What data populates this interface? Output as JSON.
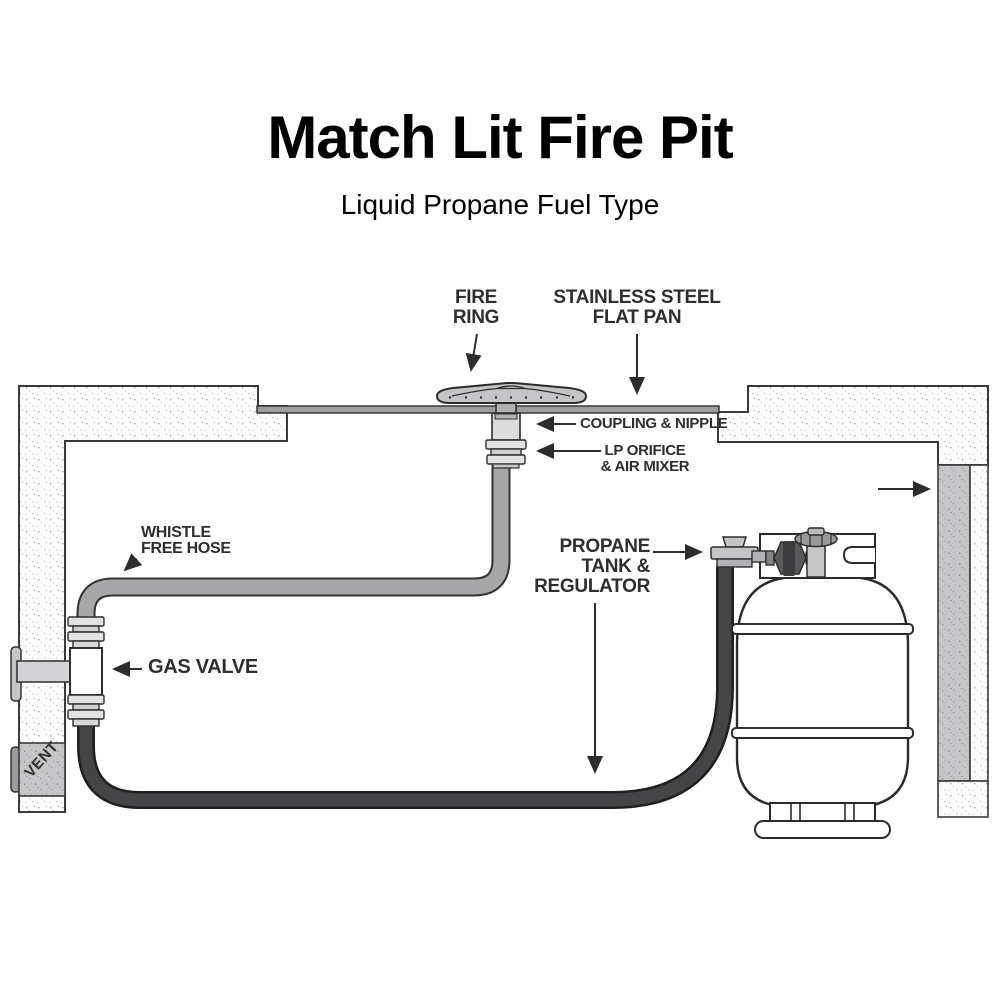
{
  "title": {
    "main": "Match Lit Fire Pit",
    "subtitle": "Liquid Propane Fuel Type"
  },
  "diagram": {
    "kind": "fire-pit-installation-cross-section",
    "labels": {
      "fire_ring": "FIRE\nRING",
      "flat_pan": "STAINLESS STEEL\nFLAT PAN",
      "coupling_nipple": "COUPLING & NIPPLE",
      "lp_orifice": "LP ORIFICE\n& AIR MIXER",
      "whistle_free_hose": "WHISTLE\nFREE HOSE",
      "gas_valve": "GAS VALVE",
      "propane_tank": "PROPANE\nTANK &\nREGULATOR",
      "vent": "VENT"
    },
    "colors": {
      "title_text": "#000000",
      "label_text": "#2e2e30",
      "outline": "#2b2b2b",
      "pan_gray": "#9e9ea0",
      "hose_gray": "#a7a7a9",
      "hose_black": "#454547",
      "metal_light": "#dcdcdc",
      "regulator_dark": "#59595c",
      "vent_gray": "#bdbdbf"
    }
  }
}
